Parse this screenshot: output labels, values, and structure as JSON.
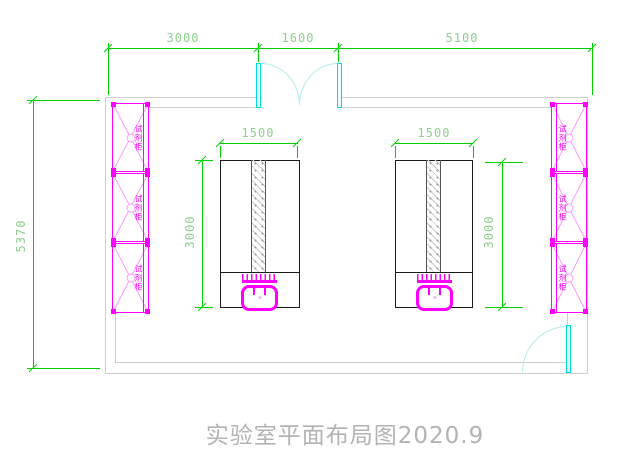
{
  "drawing": {
    "title": "实验室平面布局图2020.9"
  },
  "dims": {
    "top_left": "3000",
    "top_mid": "1600",
    "top_right": "5100",
    "left_total": "5370",
    "bench1_width": "1500",
    "bench1_depth": "3000",
    "bench2_width": "1500",
    "bench2_depth": "3000"
  },
  "cabinets": {
    "left": [
      {
        "label": "试剂柜"
      },
      {
        "label": "试剂柜"
      },
      {
        "label": "试剂柜"
      }
    ],
    "right": [
      {
        "label": "试剂柜"
      },
      {
        "label": "试剂柜"
      },
      {
        "label": "试剂柜"
      }
    ]
  },
  "colors": {
    "dimension_green": "#00cf00",
    "cabinet_magenta": "#ff00ff",
    "door_cyan": "#00dede",
    "wall_gray": "#cfcfcf",
    "title_gray": "#b3b3b3"
  }
}
